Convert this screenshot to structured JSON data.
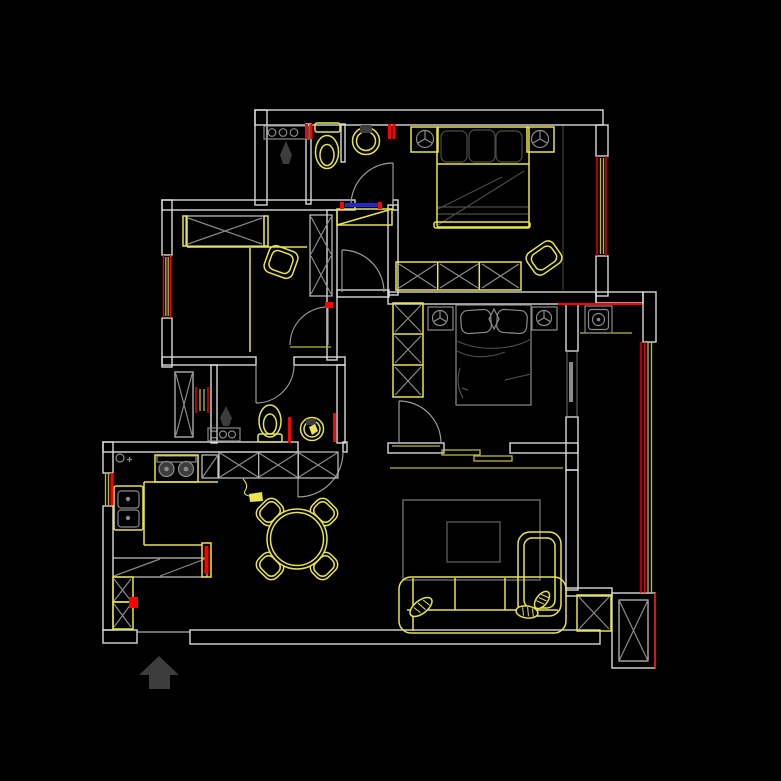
{
  "canvas": {
    "width": 781,
    "height": 781
  },
  "colors": {
    "background": "#000000",
    "wall": "#d9d9d9",
    "door": "#9a9a9a",
    "window_red": "#fe0000",
    "glass_yellow": "#b9b93a",
    "furniture_yellow": "#e8e44f",
    "gray_mid": "#8a8a8a",
    "gray_light": "#c9c9c9",
    "gray_dark": "#4b4b4b",
    "accent_blue": "#2328c8",
    "fill_dark": "#3d3d3d"
  },
  "objects": [
    "exterior-walls",
    "interior-walls",
    "window-glazing",
    "door-swings",
    "master-bed",
    "master-nightstands",
    "master-wardrobe",
    "master-chair",
    "study-wardrobe",
    "study-desk",
    "study-chair",
    "bedroom2-bed",
    "bedroom2-nightstands",
    "bedroom2-wardrobe",
    "bedroom2-sliding-door",
    "bathroom-toilet",
    "bathroom-basin",
    "shower-head",
    "shower-controls",
    "kitchen-stove",
    "kitchen-sink",
    "kitchen-counter",
    "kitchen-cabinets",
    "dining-table",
    "dining-chairs",
    "entry-marker",
    "sofa",
    "chaise",
    "sofa-pillows",
    "rug",
    "coffee-table",
    "washing-machine",
    "balcony-glazing",
    "structural-column",
    "entrance-arrow"
  ]
}
